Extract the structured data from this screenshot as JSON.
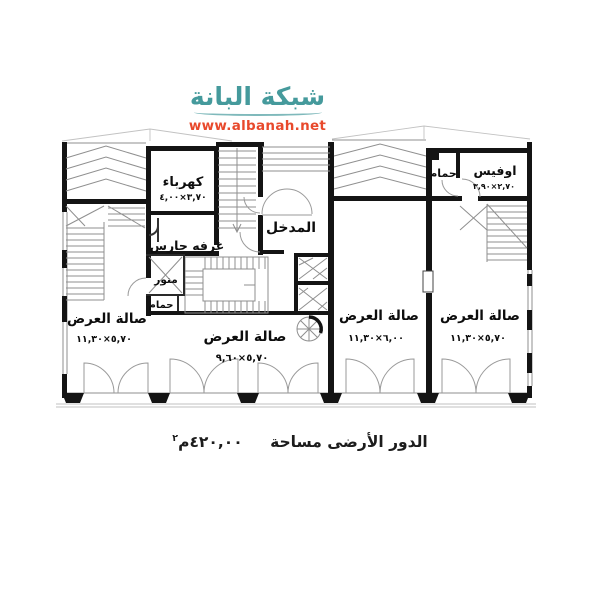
{
  "watermark": {
    "site_name": "شبكة البانة",
    "site_url": "www.albanah.net"
  },
  "caption": {
    "label": "الدور الأرضى مساحة",
    "area_value": "٤٢٠,٠٠",
    "area_unit": "م",
    "area_exponent": "٢"
  },
  "rooms": {
    "electricity": {
      "name": "كهرباء",
      "dims": "٣,٧٠×٤,٠٠"
    },
    "entrance": {
      "name": "المدخل"
    },
    "guard_room": {
      "name": "غرفه حارس"
    },
    "lightwell": {
      "name": "منور"
    },
    "bathroom_left": {
      "name": "حمام"
    },
    "bathroom_right": {
      "name": "حمام"
    },
    "office": {
      "name": "اوفيس",
      "dims": "٢,٧٠×٣,٩٠"
    },
    "showroom_left": {
      "name": "صالة العرض",
      "dims": "٥,٧٠×١١,٣٠"
    },
    "showroom_middle": {
      "name": "صالة العرض",
      "dims": "٥,٧٠×٩,٦٠"
    },
    "showroom_center": {
      "name": "صالة العرض",
      "dims": "٦,٠٠×١١,٣٠"
    },
    "showroom_right": {
      "name": "صالة العرض",
      "dims": "٥,٧٠×١١,٣٠"
    }
  },
  "colors": {
    "logo_teal": "#459a9c",
    "logo_url_red": "#e8492c",
    "wall_ink": "#141414",
    "thin_line": "#8f8f8f"
  }
}
